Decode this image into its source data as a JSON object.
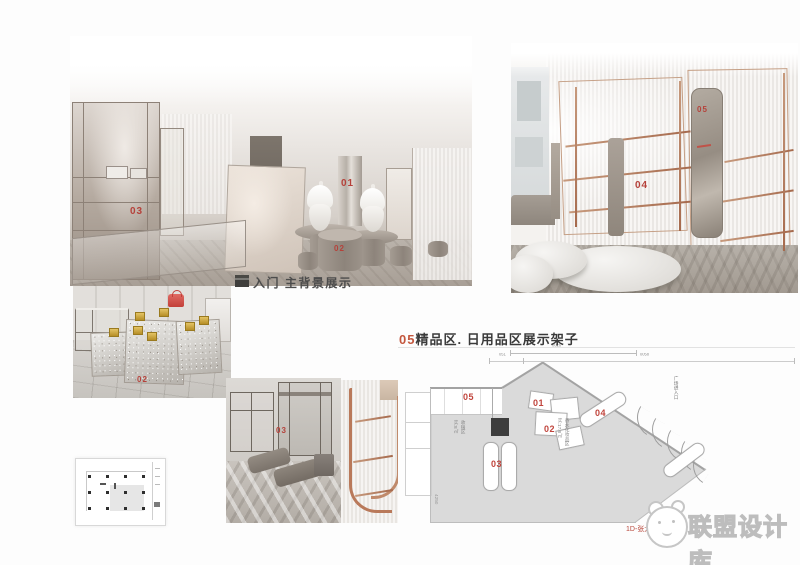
{
  "captions": {
    "entry": "入门 主背景展示",
    "plan_num": "05",
    "plan_rest": "精品区. 日用品区展示架子",
    "watermark": "联盟设计库",
    "credit_a": "1D-张大",
    "credit_b": "月"
  },
  "labels": {
    "r1_01": "01",
    "r1_02": "02",
    "r1_03": "03",
    "r2_04": "04",
    "r2_05": "05",
    "r3_02": "02",
    "r4_03": "03"
  },
  "plan": {
    "t01": "01",
    "t02": "02",
    "t03": "03",
    "t04": "04",
    "t05": "05",
    "dim_top": "0026",
    "dim_small": "051",
    "dim_right": "0058",
    "dim_left": "4250",
    "entrance": "广场进入口",
    "area1a": "收银区",
    "area1b": "实:8㎡",
    "area2a": "香水化妆品区",
    "area2b": "实:17.8㎡"
  },
  "colors": {
    "label_red": "#b5413a",
    "copper": "#b9795a",
    "title_orange": "#c4573e",
    "watermark_gray": "#c2c2c2"
  }
}
